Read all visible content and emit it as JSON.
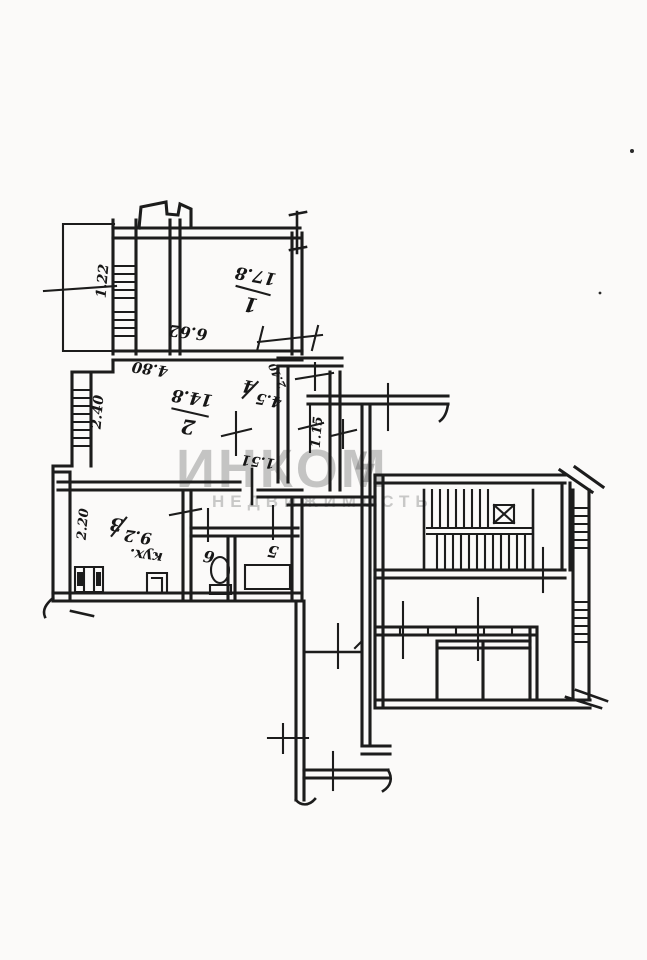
{
  "document": {
    "kind": "scanned apartment floor plan",
    "paper_color": "#fbfaf9",
    "ink_color": "#1c1c1c"
  },
  "watermark": {
    "brand": "ИНКОМ",
    "bolt_glyph": "ϟ",
    "tagline": "НЕДВИЖИМОСТЬ"
  },
  "rooms": [
    {
      "number": "1",
      "area": "17.8"
    },
    {
      "number": "2",
      "area": "14.8"
    },
    {
      "number": "3",
      "area": "9.2",
      "annotation": "кух."
    },
    {
      "number": "4",
      "area": "4.5"
    },
    {
      "number": "5"
    },
    {
      "number": "6"
    }
  ],
  "dimensions": {
    "room1_length": "6.62",
    "room2_width": "4.80",
    "room2_window": "2.40",
    "balcony_width": "1.22",
    "hall4_width": "2.40",
    "corridor_width": "1.15",
    "hall_length": "1.51",
    "kitchen_window": "2.20"
  }
}
